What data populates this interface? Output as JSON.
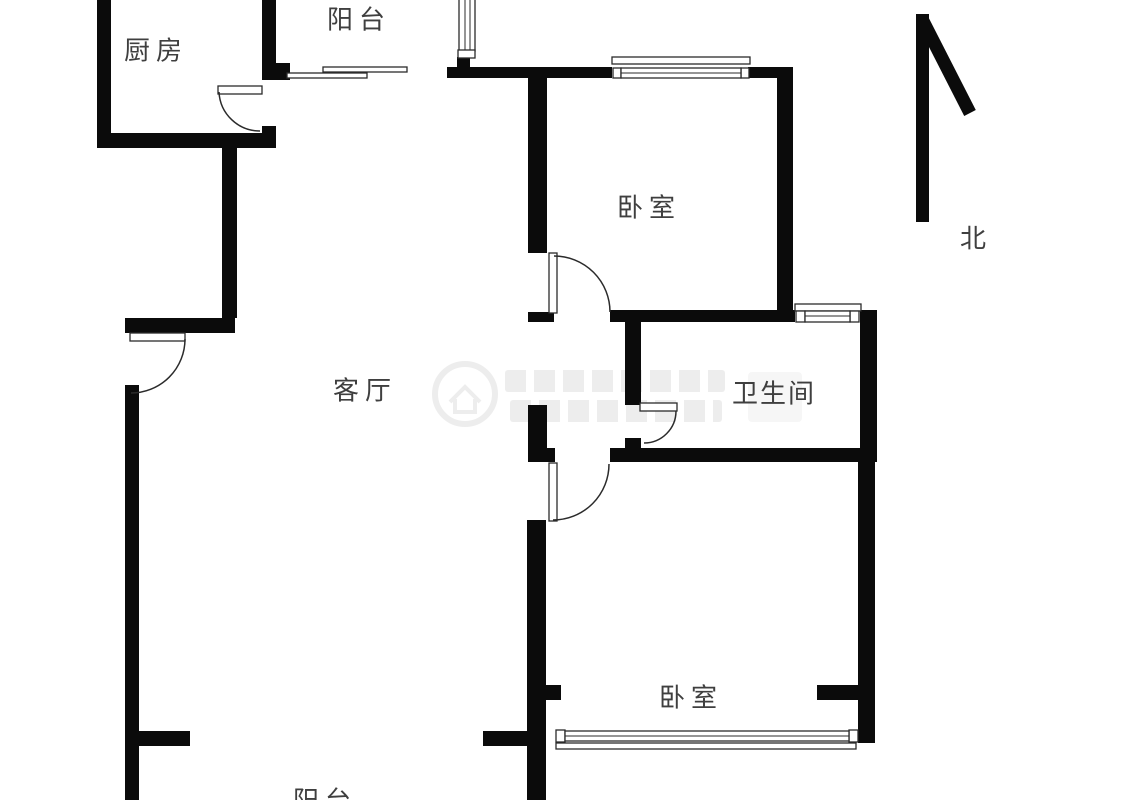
{
  "title": "两室一厅户型图",
  "rooms": {
    "kitchen": {
      "label": "厨房"
    },
    "balcony_top": {
      "label": "阳台"
    },
    "bedroom_north": {
      "label": "卧室"
    },
    "living_room": {
      "label": "客厅"
    },
    "bathroom": {
      "label": "卫生间"
    },
    "bedroom_south": {
      "label": "卧室"
    },
    "balcony_bottom": {
      "label": "阳台"
    }
  },
  "compass": {
    "label": "北",
    "direction": "up-left-arrow"
  },
  "features": {
    "doors": [
      "kitchen-door",
      "entry-door",
      "bedroom-north-door",
      "bathroom-door",
      "bedroom-south-door"
    ],
    "windows": [
      "balcony-top-window",
      "bedroom-north-window",
      "bathroom-window",
      "bedroom-south-window"
    ],
    "sliding_door": "kitchen-to-balcony-rails"
  },
  "colors": {
    "wall": "#0b0b0b",
    "line": "#2b2b2b",
    "label": "#3f3f3f",
    "watermark": "#ededed"
  },
  "watermark": {
    "present": true,
    "description": "faint circular house logo with two rows of illegible gray text"
  }
}
